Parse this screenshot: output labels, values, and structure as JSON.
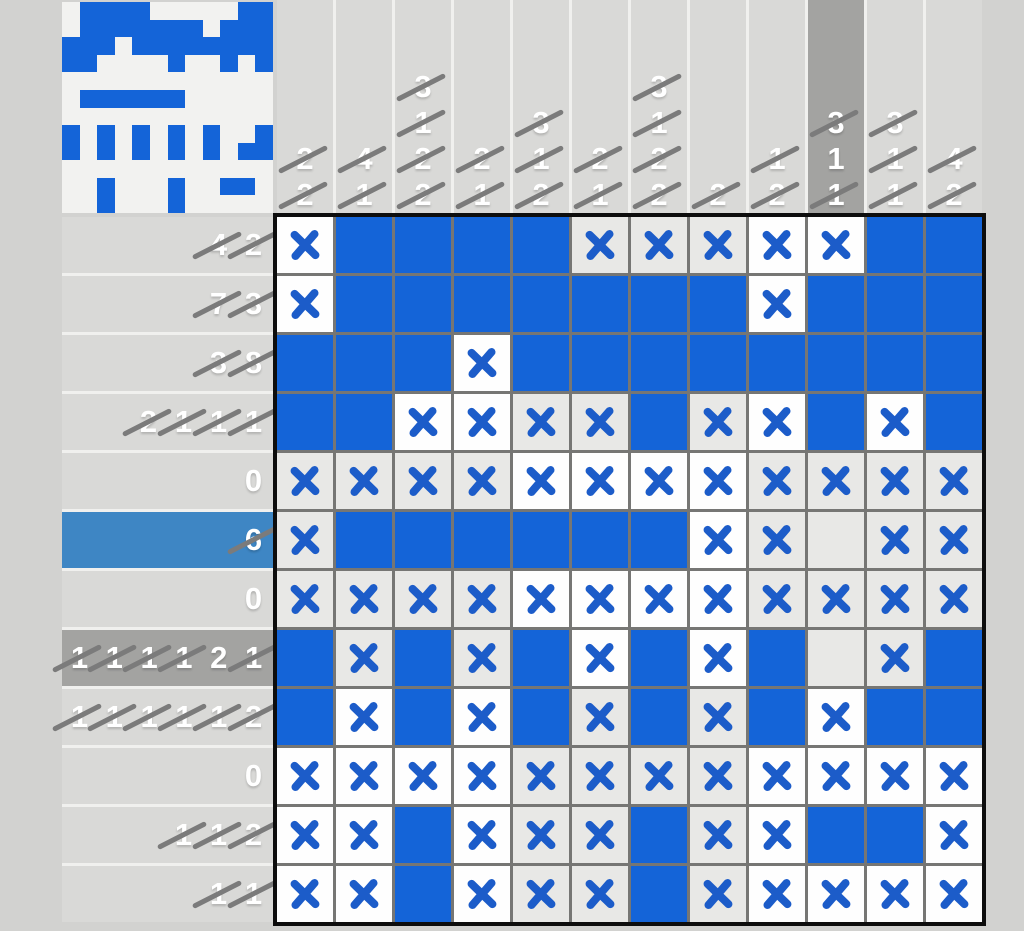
{
  "puzzle": {
    "size": 12,
    "legend": {
      "f": "filled",
      "x": "crossed-off",
      "e": "empty"
    },
    "grid_rows": [
      "xffffxxxxxff",
      "xfffffffxfff",
      "fffxffffffff",
      "ffxxxxfxxfxf",
      "xxxxxxxxxxxx",
      "xffffffxxexx",
      "xxxxxxxxxxxx",
      "fxfxfxfxfexf",
      "fxfxfxfxfxff",
      "xxxxxxxxxxxx",
      "xxfxxxfxxffx",
      "xxfxxxfxxxxx"
    ],
    "row_clues": [
      {
        "highlight": null,
        "numbers": [
          {
            "value": 4,
            "crossed": true
          },
          {
            "value": 2,
            "crossed": true
          }
        ]
      },
      {
        "highlight": null,
        "numbers": [
          {
            "value": 7,
            "crossed": true
          },
          {
            "value": 3,
            "crossed": true
          }
        ]
      },
      {
        "highlight": null,
        "numbers": [
          {
            "value": 3,
            "crossed": true
          },
          {
            "value": 8,
            "crossed": true
          }
        ]
      },
      {
        "highlight": null,
        "numbers": [
          {
            "value": 2,
            "crossed": true
          },
          {
            "value": 1,
            "crossed": true
          },
          {
            "value": 1,
            "crossed": true
          },
          {
            "value": 1,
            "crossed": true
          }
        ]
      },
      {
        "highlight": null,
        "numbers": [
          {
            "value": 0,
            "crossed": false
          }
        ]
      },
      {
        "highlight": "blue",
        "numbers": [
          {
            "value": 6,
            "crossed": true
          }
        ]
      },
      {
        "highlight": null,
        "numbers": [
          {
            "value": 0,
            "crossed": false
          }
        ]
      },
      {
        "highlight": "dark",
        "numbers": [
          {
            "value": 1,
            "crossed": true
          },
          {
            "value": 1,
            "crossed": true
          },
          {
            "value": 1,
            "crossed": true
          },
          {
            "value": 1,
            "crossed": true
          },
          {
            "value": 2,
            "crossed": false
          },
          {
            "value": 1,
            "crossed": true
          }
        ]
      },
      {
        "highlight": null,
        "numbers": [
          {
            "value": 1,
            "crossed": true
          },
          {
            "value": 1,
            "crossed": true
          },
          {
            "value": 1,
            "crossed": true
          },
          {
            "value": 1,
            "crossed": true
          },
          {
            "value": 1,
            "crossed": true
          },
          {
            "value": 2,
            "crossed": true
          }
        ]
      },
      {
        "highlight": null,
        "numbers": [
          {
            "value": 0,
            "crossed": false
          }
        ]
      },
      {
        "highlight": null,
        "numbers": [
          {
            "value": 1,
            "crossed": true
          },
          {
            "value": 1,
            "crossed": true
          },
          {
            "value": 2,
            "crossed": true
          }
        ]
      },
      {
        "highlight": null,
        "numbers": [
          {
            "value": 1,
            "crossed": true
          },
          {
            "value": 1,
            "crossed": true
          }
        ]
      }
    ],
    "col_clues": [
      {
        "highlight": null,
        "numbers": [
          {
            "value": 2,
            "crossed": true
          },
          {
            "value": 2,
            "crossed": true
          }
        ]
      },
      {
        "highlight": null,
        "numbers": [
          {
            "value": 4,
            "crossed": true
          },
          {
            "value": 1,
            "crossed": true
          }
        ]
      },
      {
        "highlight": null,
        "numbers": [
          {
            "value": 3,
            "crossed": true
          },
          {
            "value": 1,
            "crossed": true
          },
          {
            "value": 2,
            "crossed": true
          },
          {
            "value": 2,
            "crossed": true
          }
        ]
      },
      {
        "highlight": null,
        "numbers": [
          {
            "value": 2,
            "crossed": true
          },
          {
            "value": 1,
            "crossed": true
          }
        ]
      },
      {
        "highlight": null,
        "numbers": [
          {
            "value": 3,
            "crossed": true
          },
          {
            "value": 1,
            "crossed": true
          },
          {
            "value": 2,
            "crossed": true
          }
        ]
      },
      {
        "highlight": null,
        "numbers": [
          {
            "value": 2,
            "crossed": true
          },
          {
            "value": 1,
            "crossed": true
          }
        ]
      },
      {
        "highlight": null,
        "numbers": [
          {
            "value": 3,
            "crossed": true
          },
          {
            "value": 1,
            "crossed": true
          },
          {
            "value": 2,
            "crossed": true
          },
          {
            "value": 2,
            "crossed": true
          }
        ]
      },
      {
        "highlight": null,
        "numbers": [
          {
            "value": 2,
            "crossed": true
          }
        ]
      },
      {
        "highlight": null,
        "numbers": [
          {
            "value": 1,
            "crossed": true
          },
          {
            "value": 2,
            "crossed": true
          }
        ]
      },
      {
        "highlight": "dark",
        "numbers": [
          {
            "value": 3,
            "crossed": true
          },
          {
            "value": 1,
            "crossed": false
          },
          {
            "value": 1,
            "crossed": true
          }
        ]
      },
      {
        "highlight": null,
        "numbers": [
          {
            "value": 3,
            "crossed": true
          },
          {
            "value": 1,
            "crossed": true
          },
          {
            "value": 1,
            "crossed": true
          }
        ]
      },
      {
        "highlight": null,
        "numbers": [
          {
            "value": 4,
            "crossed": true
          },
          {
            "value": 2,
            "crossed": true
          }
        ]
      }
    ],
    "colors": {
      "page_bg": "#d2d2d0",
      "preview_bg": "#f2f2f0",
      "separator": "#f0f0ee",
      "band_gray": "#d9d9d7",
      "focus_gray": "#a3a3a1",
      "selected_blue": "#3e86c4",
      "clue_text": "#ffffff",
      "strike": "#7b7b7b",
      "fill_blue": "#1464d8",
      "x_blue": "#1c5cc9",
      "cell_white": "#fefefe",
      "cell_gray": "#e8e8e6",
      "grid_line": "#767674",
      "border_black": "#0d0d0d"
    }
  }
}
